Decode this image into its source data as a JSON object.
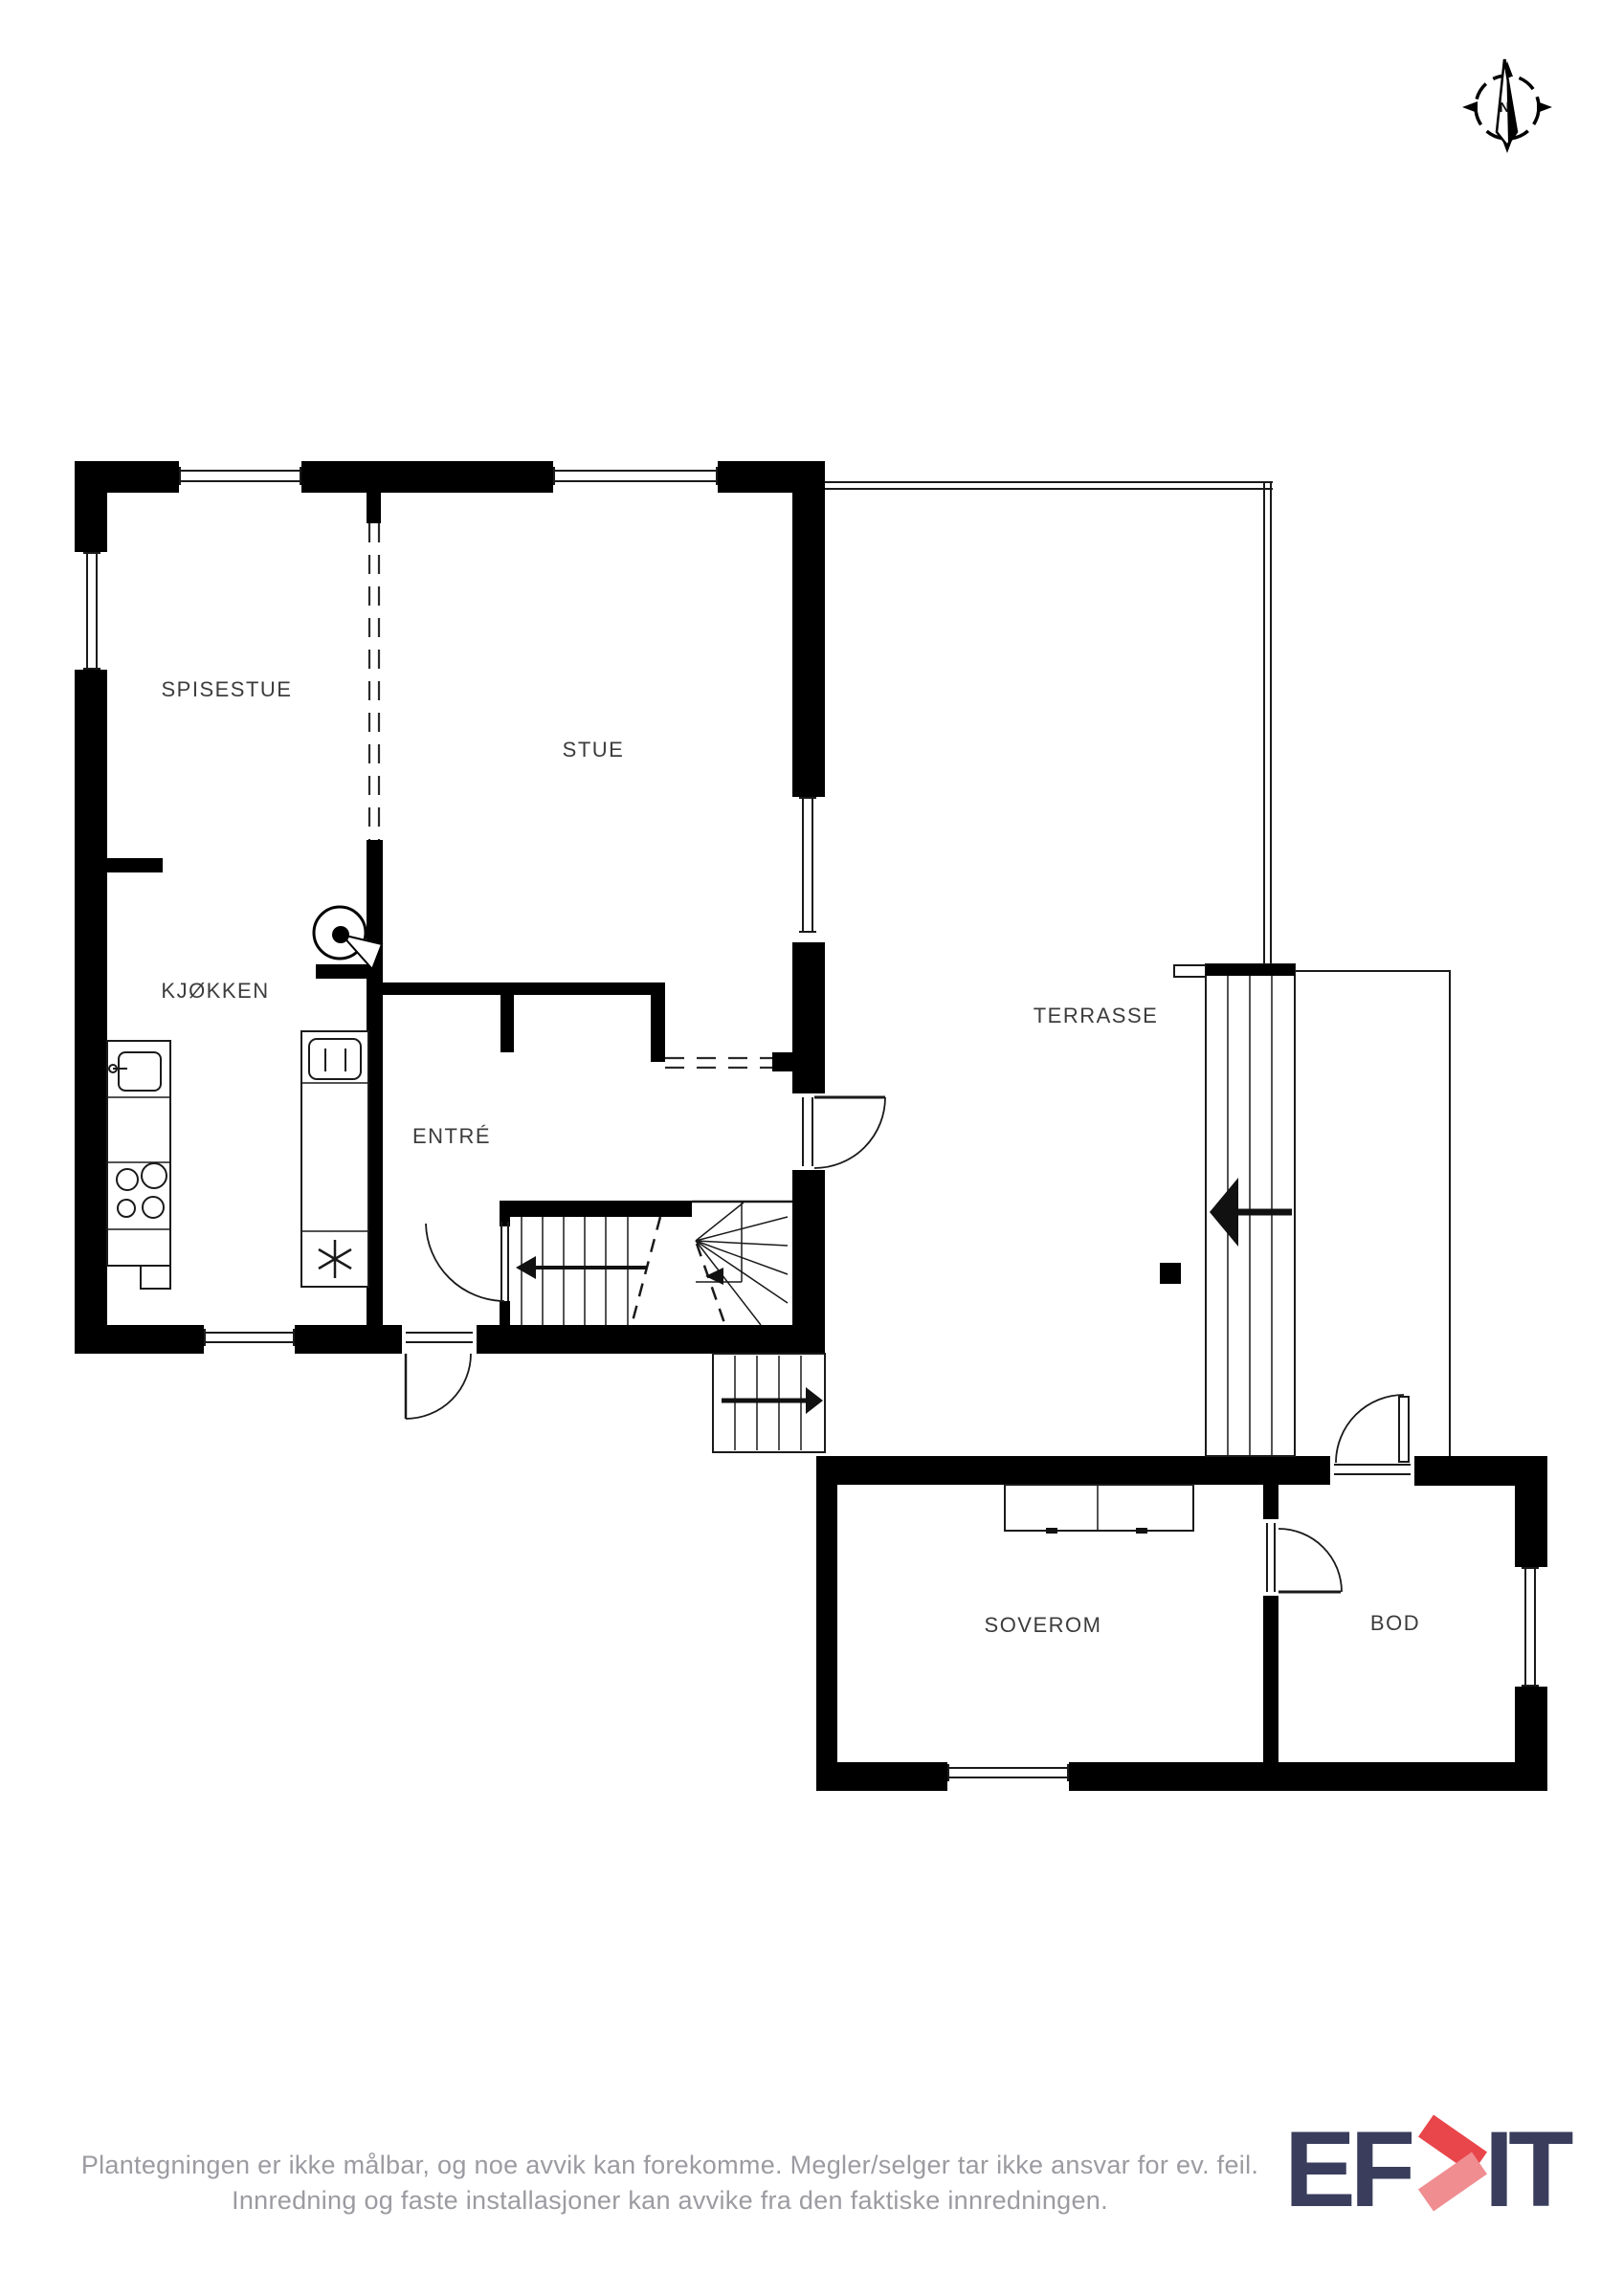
{
  "rooms": [
    {
      "label": "SPISESTUE"
    },
    {
      "label": "STUE"
    },
    {
      "label": "KJØKKEN"
    },
    {
      "label": "ENTRÉ"
    },
    {
      "label": "TERRASSE"
    },
    {
      "label": "SOVEROM"
    },
    {
      "label": "BOD"
    }
  ],
  "compass": {
    "north_label": "N"
  },
  "disclaimer": {
    "line1": "Plantegningen er ikke målbar, og noe avvik kan forekomme. Megler/selger tar ikke ansvar for ev. feil.",
    "line2": "Innredning og faste installasjoner kan avvike fra den faktiske innredningen."
  },
  "logo": {
    "brand": "EFKT",
    "text_left": "EF",
    "text_right": "IT",
    "navy": "#3a3e5c",
    "chevron_red": "#e9464b",
    "chevron_light_red": "#ef8d91"
  },
  "colors": {
    "wall": "#000000",
    "line": "#1a1a1a",
    "label_text": "#3c3c3c",
    "disclaimer_text": "#9b9ba1"
  }
}
